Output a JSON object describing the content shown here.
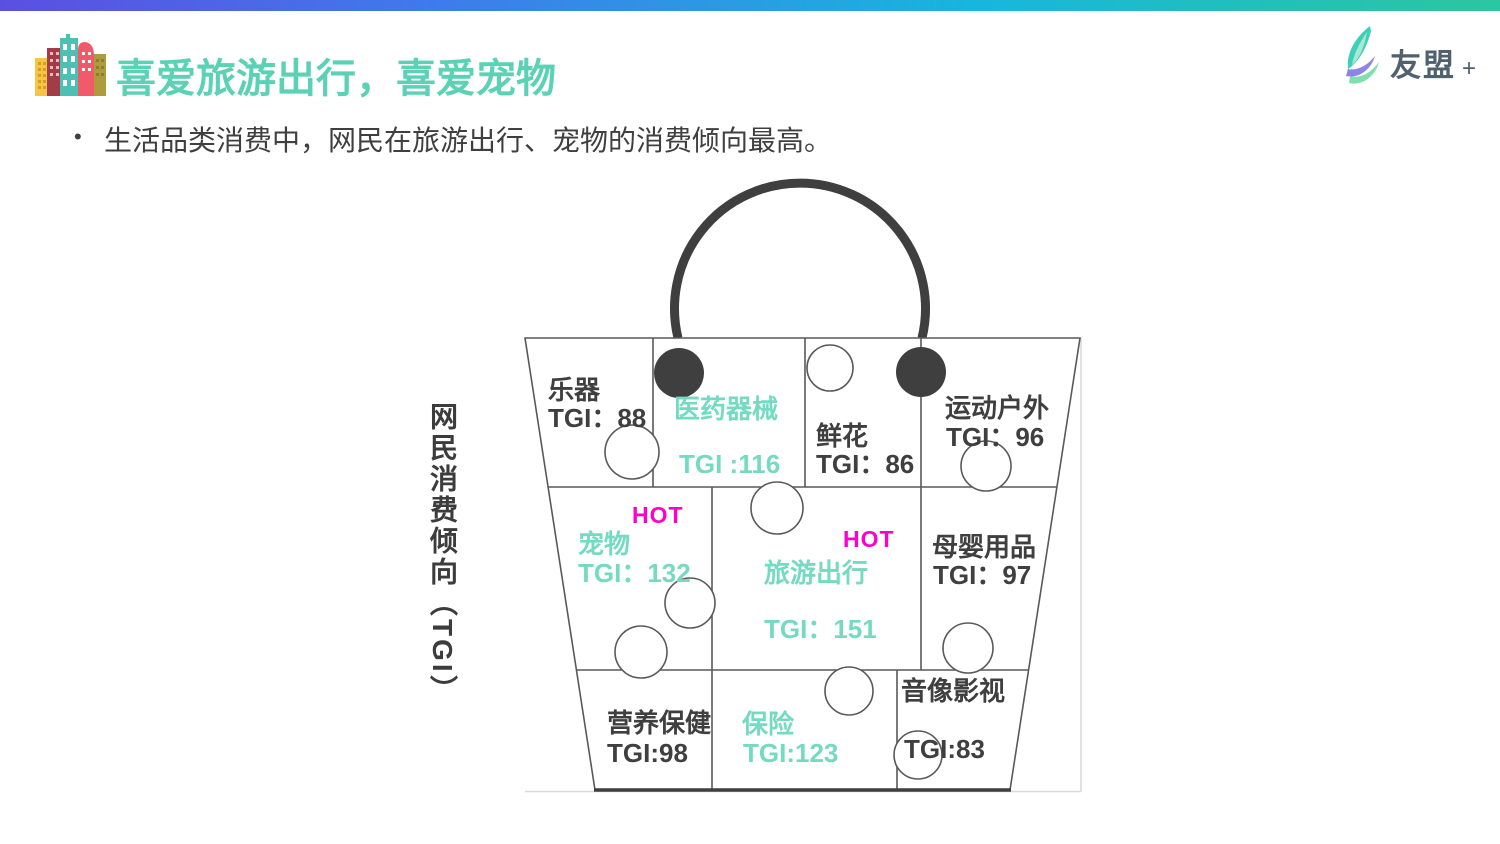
{
  "page": {
    "title": "喜爱旅游出行，喜爱宠物",
    "bullet_marker": "•",
    "bullet": "生活品类消费中，网民在旅游出行、宠物的消费倾向最高。",
    "axis_label": "网民消费倾向（TGI）"
  },
  "logo": {
    "text": "友盟",
    "plus": "+"
  },
  "hot_label": "HOT",
  "cells": {
    "music": {
      "name": "乐器",
      "tgi": "TGI：88"
    },
    "medical": {
      "name": "医药器械",
      "tgi": "TGI :116"
    },
    "flowers": {
      "name": "鲜花",
      "tgi": "TGI：86"
    },
    "sports": {
      "name": "运动户外",
      "tgi": "TGI：96"
    },
    "pets": {
      "name": "宠物",
      "tgi": "TGI：132"
    },
    "travel": {
      "name": "旅游出行",
      "tgi": "TGI：151"
    },
    "baby": {
      "name": "母婴用品",
      "tgi": "TGI：97"
    },
    "nutrition": {
      "name": "营养保健",
      "tgi": "TGI:98"
    },
    "insurance": {
      "name": "保险",
      "tgi": "TGI:123"
    },
    "av_media": {
      "name": "音像影视",
      "tgi": "TGI:83"
    }
  },
  "chart_data": {
    "type": "diagram",
    "title": "喜爱旅游出行，喜爱宠物",
    "axis_label": "网民消费倾向（TGI）",
    "categories": [
      "乐器",
      "医药器械",
      "鲜花",
      "运动户外",
      "宠物",
      "旅游出行",
      "母婴用品",
      "营养保健",
      "保险",
      "音像影视"
    ],
    "values": [
      88,
      116,
      86,
      96,
      132,
      151,
      97,
      98,
      123,
      83
    ],
    "hot_items": [
      "宠物",
      "旅游出行"
    ],
    "teal_highlighted_items": [
      "医药器械",
      "宠物",
      "旅游出行",
      "保险"
    ]
  },
  "colors": {
    "title_teal": "#5bd1b5",
    "cell_teal": "#74dac1",
    "hot_magenta": "#ff00cc",
    "text_dark": "#3f3f3f",
    "outline_gray": "#595959",
    "light_gray_line": "#d9d9d9",
    "bar_gradient_left": "#5b4fe1",
    "bar_gradient_mid": "#18b6dc",
    "bar_gradient_right": "#2bc79f"
  }
}
